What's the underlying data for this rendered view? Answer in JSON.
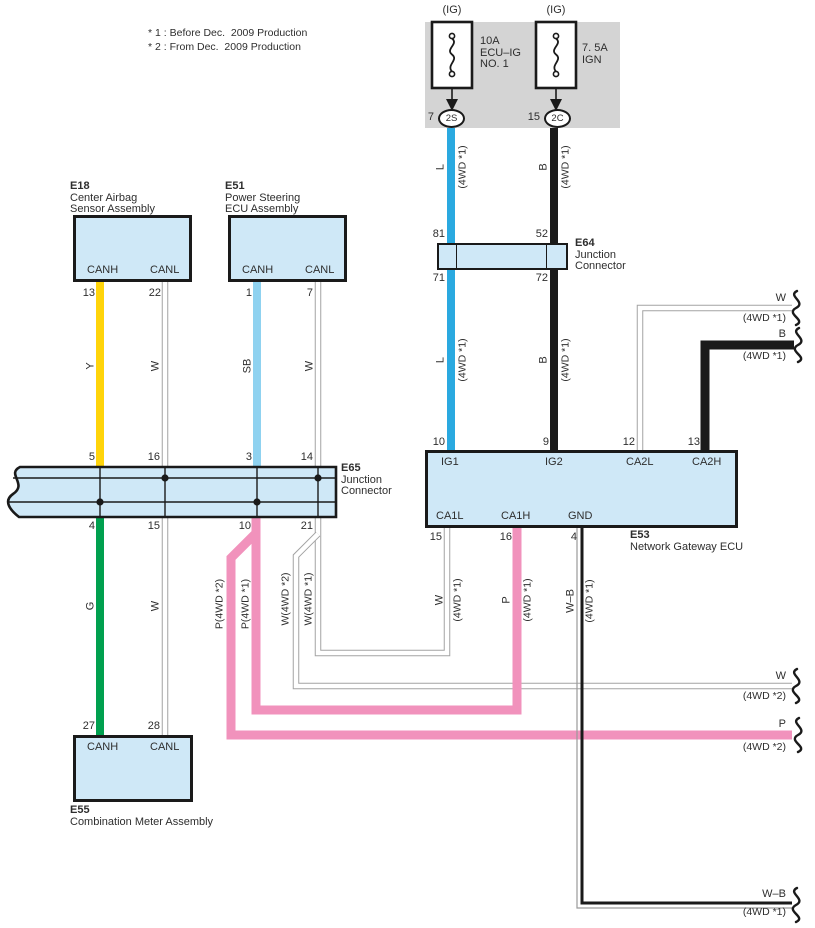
{
  "colors": {
    "text": "#2e2e2e",
    "box_fill": "#cfe8f7",
    "box_border": "#1a1a1a",
    "gray_panel": "#d4d4d4",
    "wire_blue": "#2aa9e0",
    "wire_skyblue": "#8fd2f0",
    "wire_yellow": "#ffd40a",
    "wire_green": "#00a04f",
    "wire_pink": "#f192bc",
    "wire_black": "#1a1a1a",
    "wire_white_outline": "#a3a3a3"
  },
  "notes": {
    "n1": "* 1 : Before Dec.  2009 Production",
    "n2": "* 2 : From Dec.  2009 Production"
  },
  "power_panel": {
    "fuses": [
      {
        "tag": "(IG)",
        "rating": "10A",
        "name1": "ECU–IG",
        "name2": "NO. 1",
        "pin": "7",
        "connector": "2S"
      },
      {
        "tag": "(IG)",
        "rating": "7. 5A",
        "name1": "IGN",
        "pin": "15",
        "connector": "2C"
      }
    ]
  },
  "e18": {
    "id": "E18",
    "name1": "Center Airbag",
    "name2": "Sensor Assembly",
    "t1": "CANH",
    "t2": "CANL",
    "p1": "13",
    "p2": "22",
    "w1": "Y",
    "w2": "W"
  },
  "e51": {
    "id": "E51",
    "name1": "Power Steering",
    "name2": "ECU Assembly",
    "t1": "CANH",
    "t2": "CANL",
    "p1": "1",
    "p2": "7",
    "w1": "SB",
    "w2": "W"
  },
  "e64": {
    "id": "E64",
    "name1": "Junction",
    "name2": "Connector",
    "p_tl": "81",
    "p_tr": "52",
    "p_bl": "71",
    "p_br": "72"
  },
  "e65": {
    "id": "E65",
    "name1": "Junction",
    "name2": "Connector",
    "top_pins": [
      "5",
      "16",
      "3",
      "14"
    ],
    "bottom_pins": [
      "4",
      "15",
      "10",
      "21"
    ]
  },
  "e53": {
    "id": "E53",
    "name": "Network Gateway ECU",
    "terms_top": [
      "IG1",
      "IG2",
      "CA2L",
      "CA2H"
    ],
    "pins_top": [
      "10",
      "9",
      "12",
      "13"
    ],
    "terms_bottom": [
      "CA1L",
      "CA1H",
      "GND"
    ],
    "pins_bottom": [
      "15",
      "16",
      "4"
    ]
  },
  "e55": {
    "id": "E55",
    "name": "Combination Meter Assembly",
    "t1": "CANH",
    "t2": "CANL",
    "p1": "27",
    "p2": "28",
    "w1": "G",
    "w2": "W"
  },
  "wire_labels": {
    "l": "L",
    "b": "B",
    "w": "W",
    "p": "P",
    "wb": "W–B",
    "q41": "(4WD *1)",
    "q42": "(4WD *2)",
    "p42": "P(4WD *2)",
    "p41": "P(4WD *1)",
    "w42": "W(4WD *2)",
    "w41": "W(4WD *1)"
  },
  "offpage": {
    "top_w": {
      "code": "W",
      "qual": "(4WD *1)"
    },
    "top_b": {
      "code": "B",
      "qual": "(4WD *1)"
    },
    "mid_w": {
      "code": "W",
      "qual": "(4WD *2)"
    },
    "mid_p": {
      "code": "P",
      "qual": "(4WD *2)"
    },
    "bottom_wb": {
      "code": "W–B",
      "qual": "(4WD *1)"
    }
  }
}
